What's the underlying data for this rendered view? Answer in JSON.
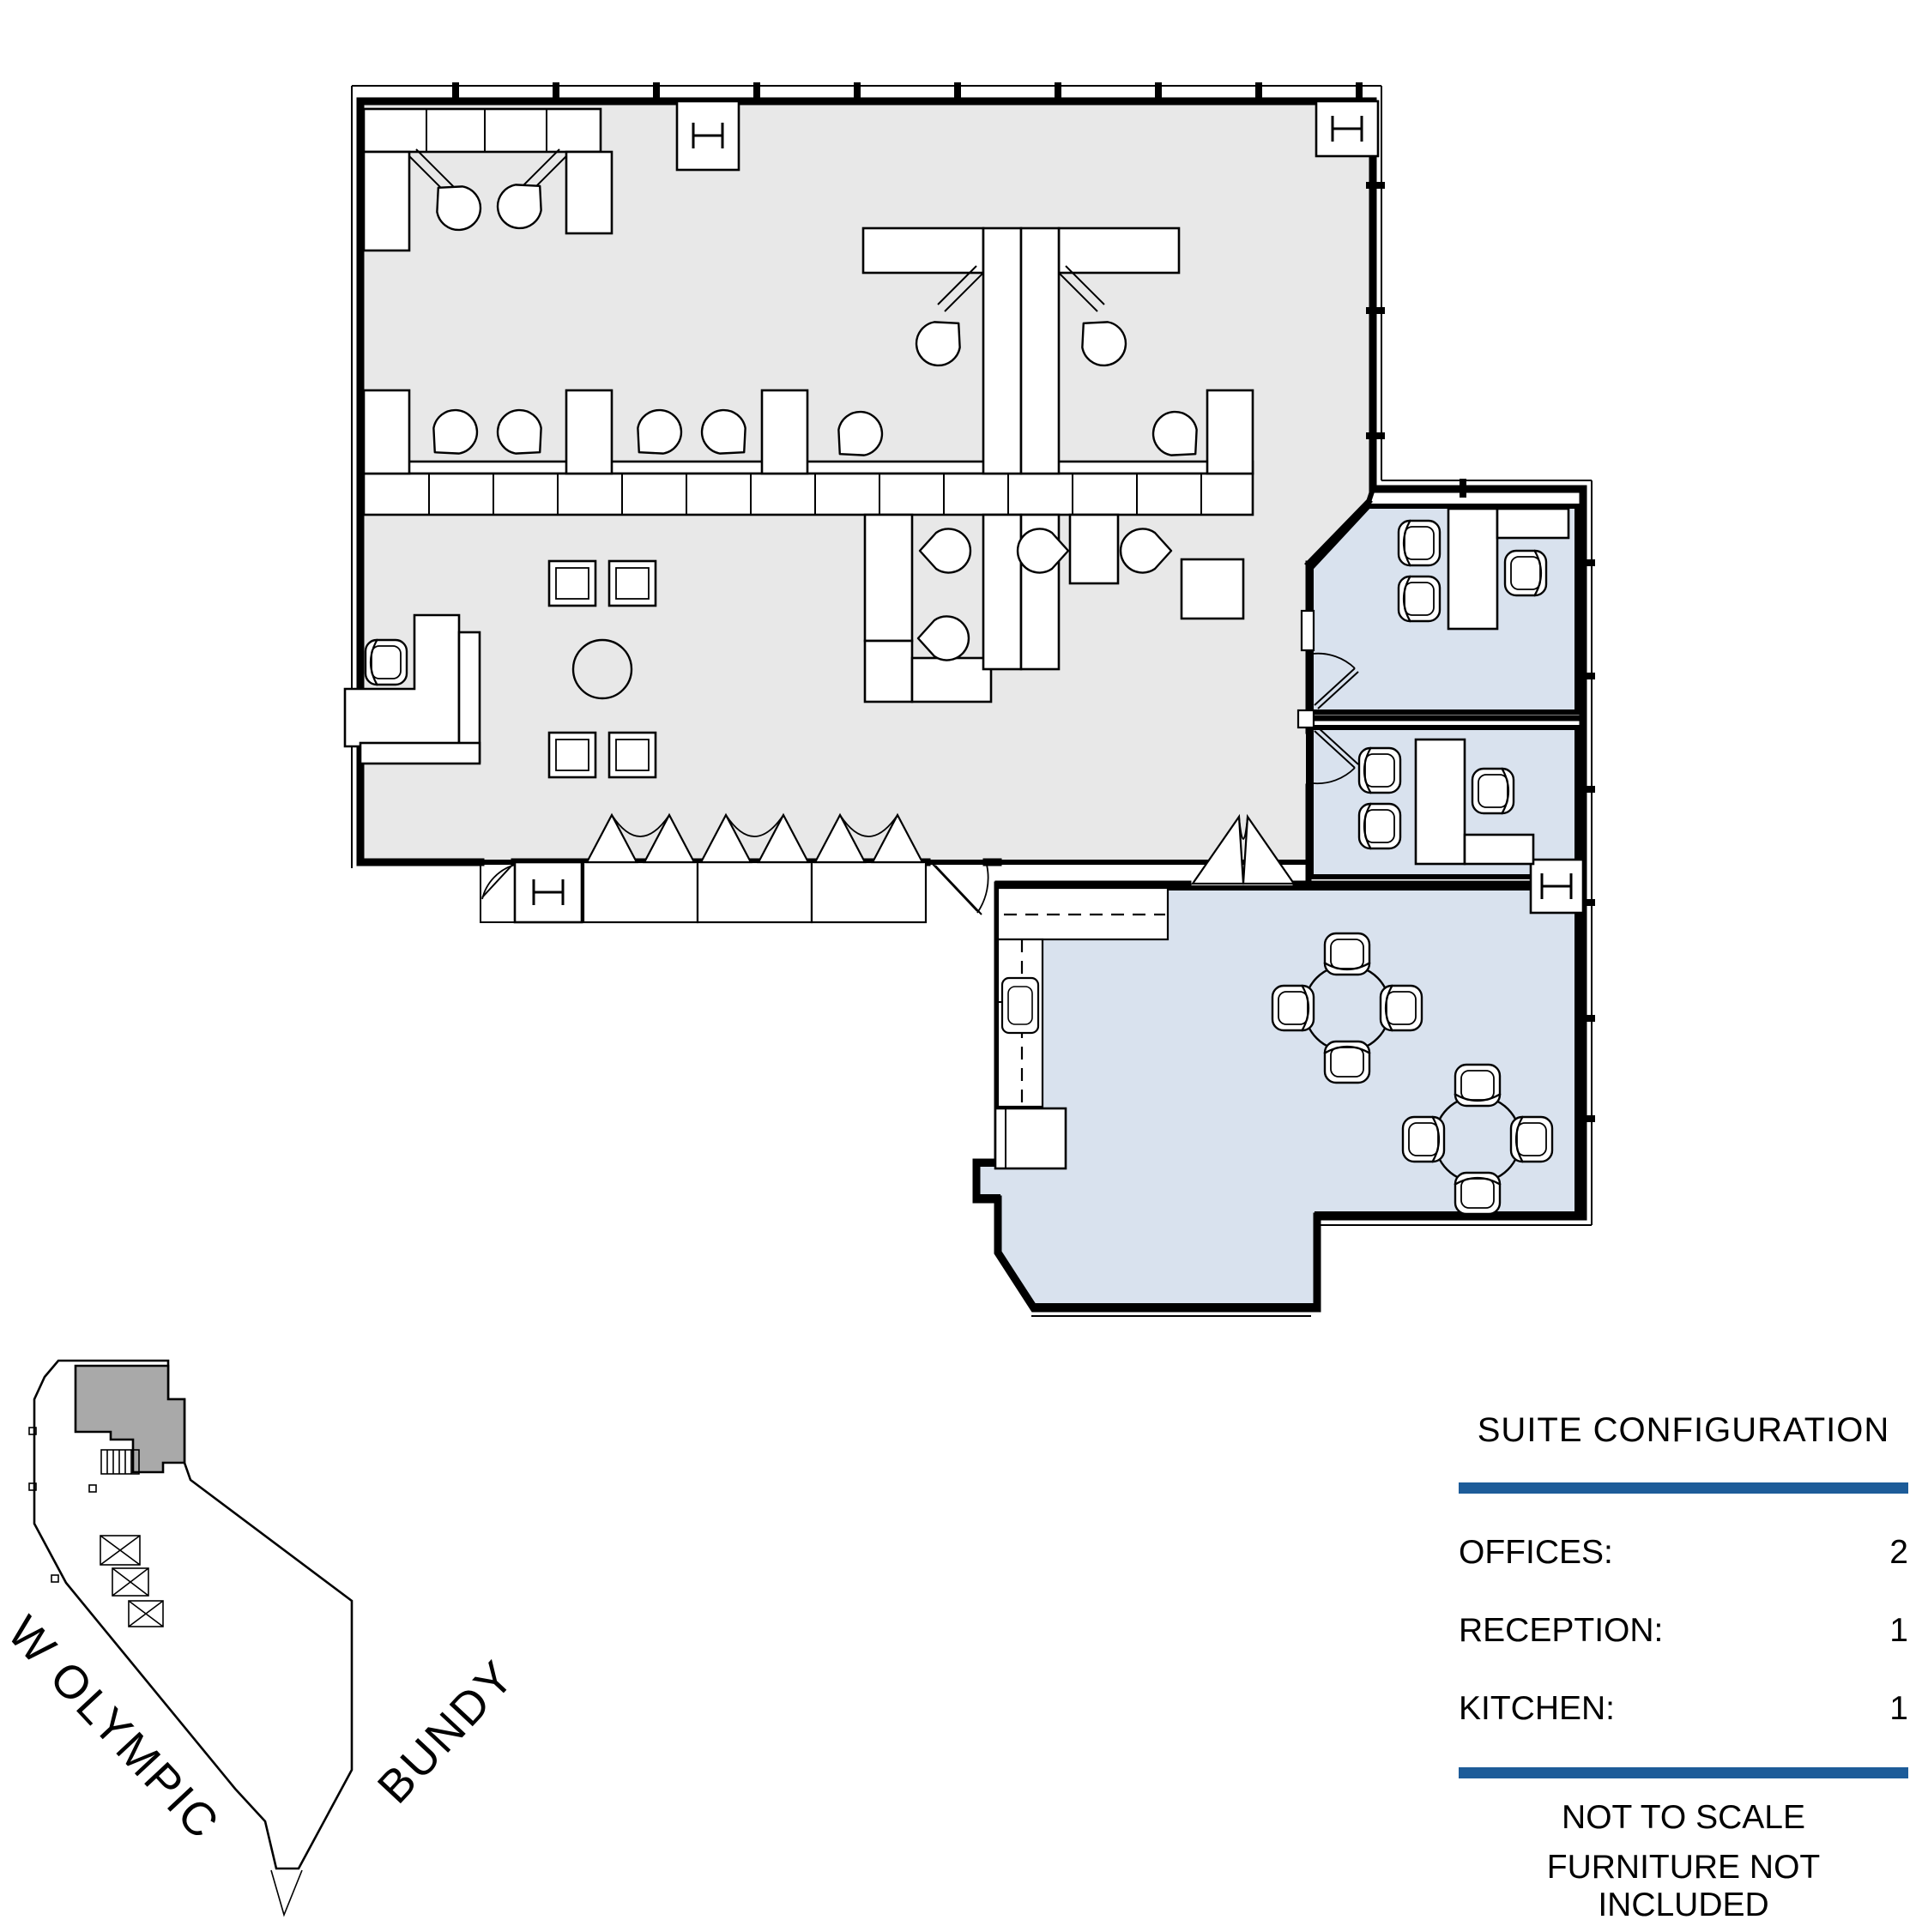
{
  "legend": {
    "title": "SUITE CONFIGURATION",
    "rows": [
      {
        "label": "OFFICES:",
        "value": "2"
      },
      {
        "label": "RECEPTION:",
        "value": "1"
      },
      {
        "label": "KITCHEN:",
        "value": "1"
      }
    ],
    "notes": [
      "NOT TO SCALE",
      "FURNITURE NOT INCLUDED"
    ]
  },
  "key_plan": {
    "streets": [
      {
        "name": "W OLYMPIC"
      },
      {
        "name": "BUNDY"
      }
    ]
  },
  "colors": {
    "accent": "#1D5C99",
    "open_area": "#E8E8E8",
    "suite_room": "#D9E2EE",
    "keyplan_suite": "#A9A9A9",
    "line": "#000000",
    "paper": "#FFFFFF"
  }
}
